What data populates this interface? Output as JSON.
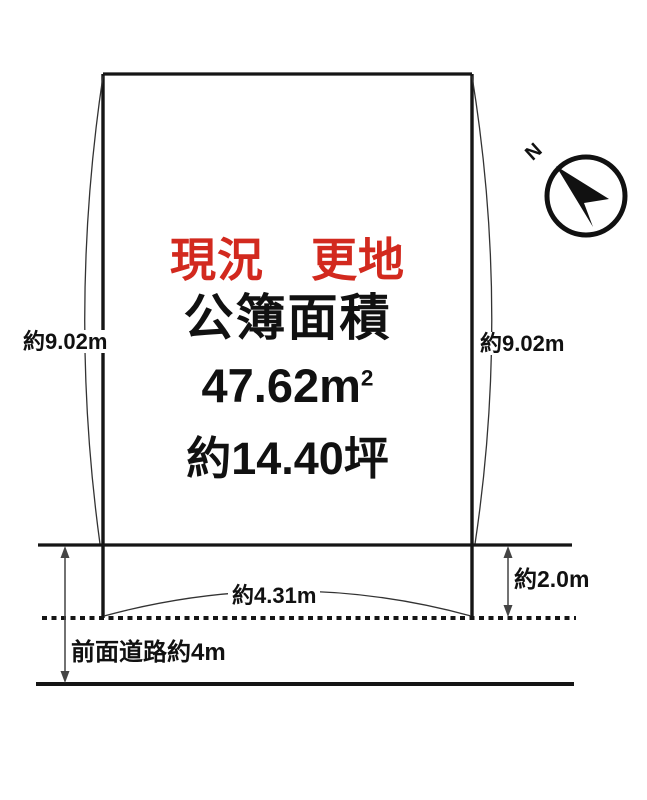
{
  "diagram": {
    "title": "land plot survey diagram",
    "status_label": "現況　更地",
    "area_title": "公簿面積",
    "area_sqm_value": "47.62m",
    "area_sqm_sup": "2",
    "area_tsubo": "約14.40坪",
    "left_side_length": "約9.02m",
    "right_side_length": "約9.02m",
    "frontage_length": "約4.31m",
    "setback_depth": "約2.0m",
    "road_label": "前面道路約4m",
    "compass_label": "N"
  },
  "colors": {
    "accent_red": "#d2291e",
    "line_black": "#151515",
    "dimension_gray": "#444444",
    "background": "#ffffff"
  }
}
